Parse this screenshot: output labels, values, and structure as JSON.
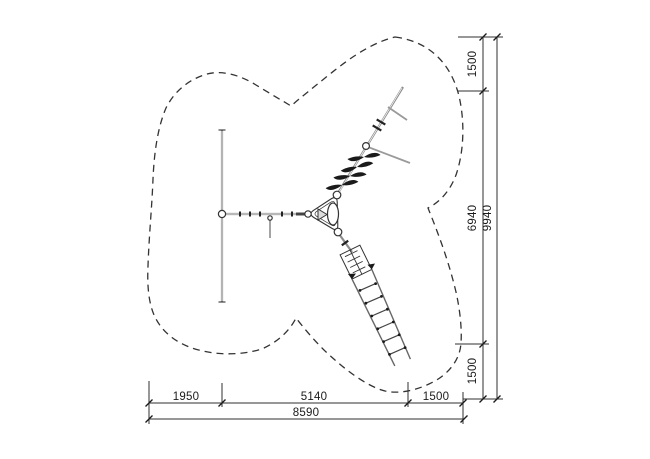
{
  "page": {
    "background": "#ffffff"
  },
  "drawing": {
    "type": "playground-equipment-plan-view",
    "line_color": "#2f2f2f",
    "beam_color": "#8c8c8c",
    "text_color": "#1a1a1a",
    "boundary_style": "dashed"
  },
  "dimensions": {
    "right": [
      {
        "id": "top-clearance",
        "label": "1500"
      },
      {
        "id": "equipment-extent",
        "label": "6940"
      },
      {
        "id": "bottom-clearance",
        "label": "1500"
      },
      {
        "id": "overall-height",
        "label": "9940"
      }
    ],
    "bottom": [
      {
        "id": "left-clearance",
        "label": "1950"
      },
      {
        "id": "equipment-extent",
        "label": "5140"
      },
      {
        "id": "right-clearance",
        "label": "1500"
      },
      {
        "id": "overall-width",
        "label": "8590"
      }
    ]
  }
}
